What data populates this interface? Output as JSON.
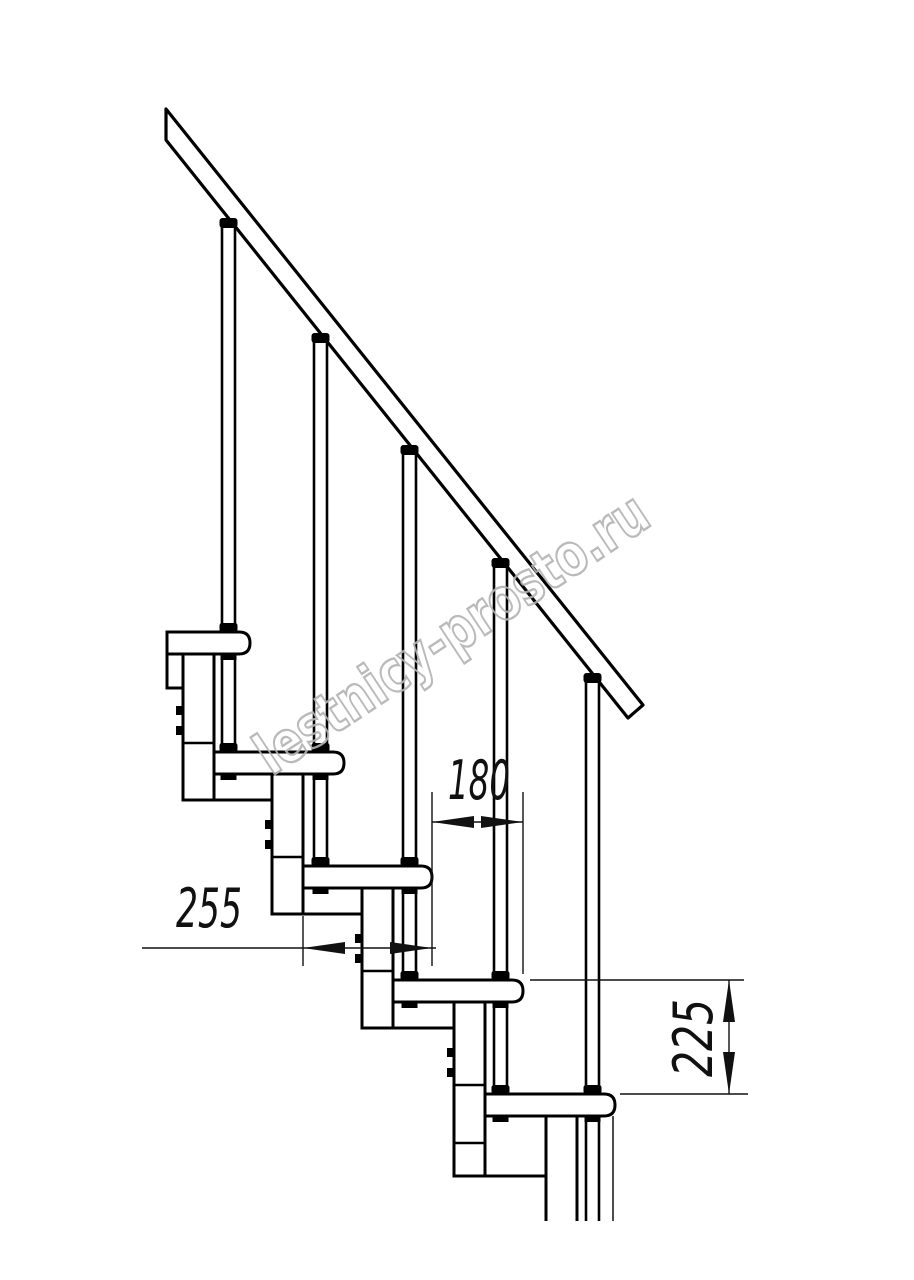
{
  "document": {
    "type": "staircase-side-view-technical-drawing",
    "background": "#ffffff",
    "line_color": "#000000",
    "dim_color": "#111111"
  },
  "watermark": {
    "text": "lestnicy-prosto.ru",
    "color": "#b3b3b3",
    "angle_deg": -33.5
  },
  "dimensions": {
    "d255": {
      "label": "255",
      "meaning": "tread-depth"
    },
    "d180": {
      "label": "180",
      "meaning": "step-run"
    },
    "d225": {
      "label": "225",
      "meaning": "step-rise"
    }
  },
  "drawing": {
    "rail": {
      "polygon": [
        [
          166,
          109
        ],
        [
          643,
          705
        ],
        [
          628,
          718
        ],
        [
          166,
          140
        ]
      ]
    },
    "rail_caps": [
      {
        "cx": 228.5,
        "y": 218
      },
      {
        "cx": 320.5,
        "y": 333
      },
      {
        "cx": 409.5,
        "y": 445
      },
      {
        "cx": 500.5,
        "y": 558
      },
      {
        "cx": 592.5,
        "y": 673
      }
    ],
    "baluster_w": 13,
    "balusters": [
      {
        "x": 222,
        "top": 227,
        "bottom": 752
      },
      {
        "x": 314,
        "top": 342,
        "bottom": 866
      },
      {
        "x": 403,
        "top": 454,
        "bottom": 980
      },
      {
        "x": 494,
        "top": 567,
        "bottom": 1094
      },
      {
        "x": 586,
        "top": 682,
        "bottom": 1221
      }
    ],
    "tread_h": 22,
    "treads": [
      {
        "x": 167,
        "nose": 250,
        "top": 632
      },
      {
        "x": 214,
        "nose": 344,
        "top": 752
      },
      {
        "x": 303,
        "nose": 432,
        "top": 866
      },
      {
        "x": 393,
        "nose": 523,
        "top": 980
      },
      {
        "x": 485,
        "nose": 615,
        "top": 1094
      }
    ],
    "col_w": 31,
    "columns": [
      {
        "x": 183,
        "top": 654,
        "bottom": 800,
        "joints": [
          743
        ],
        "bolts": [
          706,
          726
        ],
        "closed": true
      },
      {
        "x": 272,
        "top": 774,
        "bottom": 914,
        "joints": [
          857
        ],
        "bolts": [
          820,
          840
        ],
        "closed": true
      },
      {
        "x": 362,
        "top": 888,
        "bottom": 1028,
        "joints": [
          971
        ],
        "bolts": [
          934,
          954
        ],
        "closed": true
      },
      {
        "x": 454,
        "top": 1002,
        "bottom": 1176,
        "joints": [
          1085,
          1143
        ],
        "bolts": [
          1048,
          1068
        ],
        "closed": true
      },
      {
        "x": 546,
        "top": 1116,
        "bottom": 1221,
        "joints": [],
        "bolts": [],
        "closed": false
      }
    ],
    "brackets": [
      {
        "y": 800,
        "x1": 183,
        "x2": 272
      },
      {
        "y": 914,
        "x1": 272,
        "x2": 362
      },
      {
        "y": 1028,
        "x1": 362,
        "x2": 454
      },
      {
        "y": 1176,
        "x1": 454,
        "x2": 546
      }
    ],
    "stub": {
      "points": [
        [
          167,
          654
        ],
        [
          167,
          688
        ],
        [
          183,
          688
        ]
      ]
    },
    "extra_thin_lines": [
      {
        "x1": 613,
        "y1": 1116,
        "x2": 613,
        "y2": 1221
      }
    ],
    "fasteners": [
      {
        "bal": 0,
        "tread": 0
      },
      {
        "bal": 0,
        "tread": 1
      },
      {
        "bal": 1,
        "tread": 1
      },
      {
        "bal": 1,
        "tread": 2
      },
      {
        "bal": 2,
        "tread": 2
      },
      {
        "bal": 2,
        "tread": 3
      },
      {
        "bal": 3,
        "tread": 3
      },
      {
        "bal": 3,
        "tread": 4
      },
      {
        "bal": 4,
        "tread": 4
      }
    ],
    "dims": {
      "d255": {
        "ext": [
          [
            303,
            916,
            303,
            966
          ],
          [
            432,
            792,
            432,
            966
          ]
        ],
        "line": [
          142,
          948,
          436,
          948
        ],
        "arrows": [
          {
            "tip": [
              303,
              948
            ],
            "dir": "left"
          },
          {
            "tip": [
              432,
              948
            ],
            "dir": "right"
          }
        ]
      },
      "d180": {
        "ext": [
          [
            523,
            792,
            523,
            974
          ]
        ],
        "line": [
          432,
          822,
          523,
          822
        ],
        "arrows": [
          {
            "tip": [
              432,
              822
            ],
            "dir": "left"
          },
          {
            "tip": [
              523,
              822
            ],
            "dir": "right"
          }
        ]
      },
      "d225": {
        "ext": [
          [
            530,
            980,
            744,
            980
          ],
          [
            620,
            1094,
            748,
            1094
          ]
        ],
        "line": [
          729,
          980,
          729,
          1094
        ],
        "arrows": [
          {
            "tip": [
              729,
              980
            ],
            "dir": "up"
          },
          {
            "tip": [
              729,
              1094
            ],
            "dir": "down"
          }
        ]
      }
    }
  }
}
